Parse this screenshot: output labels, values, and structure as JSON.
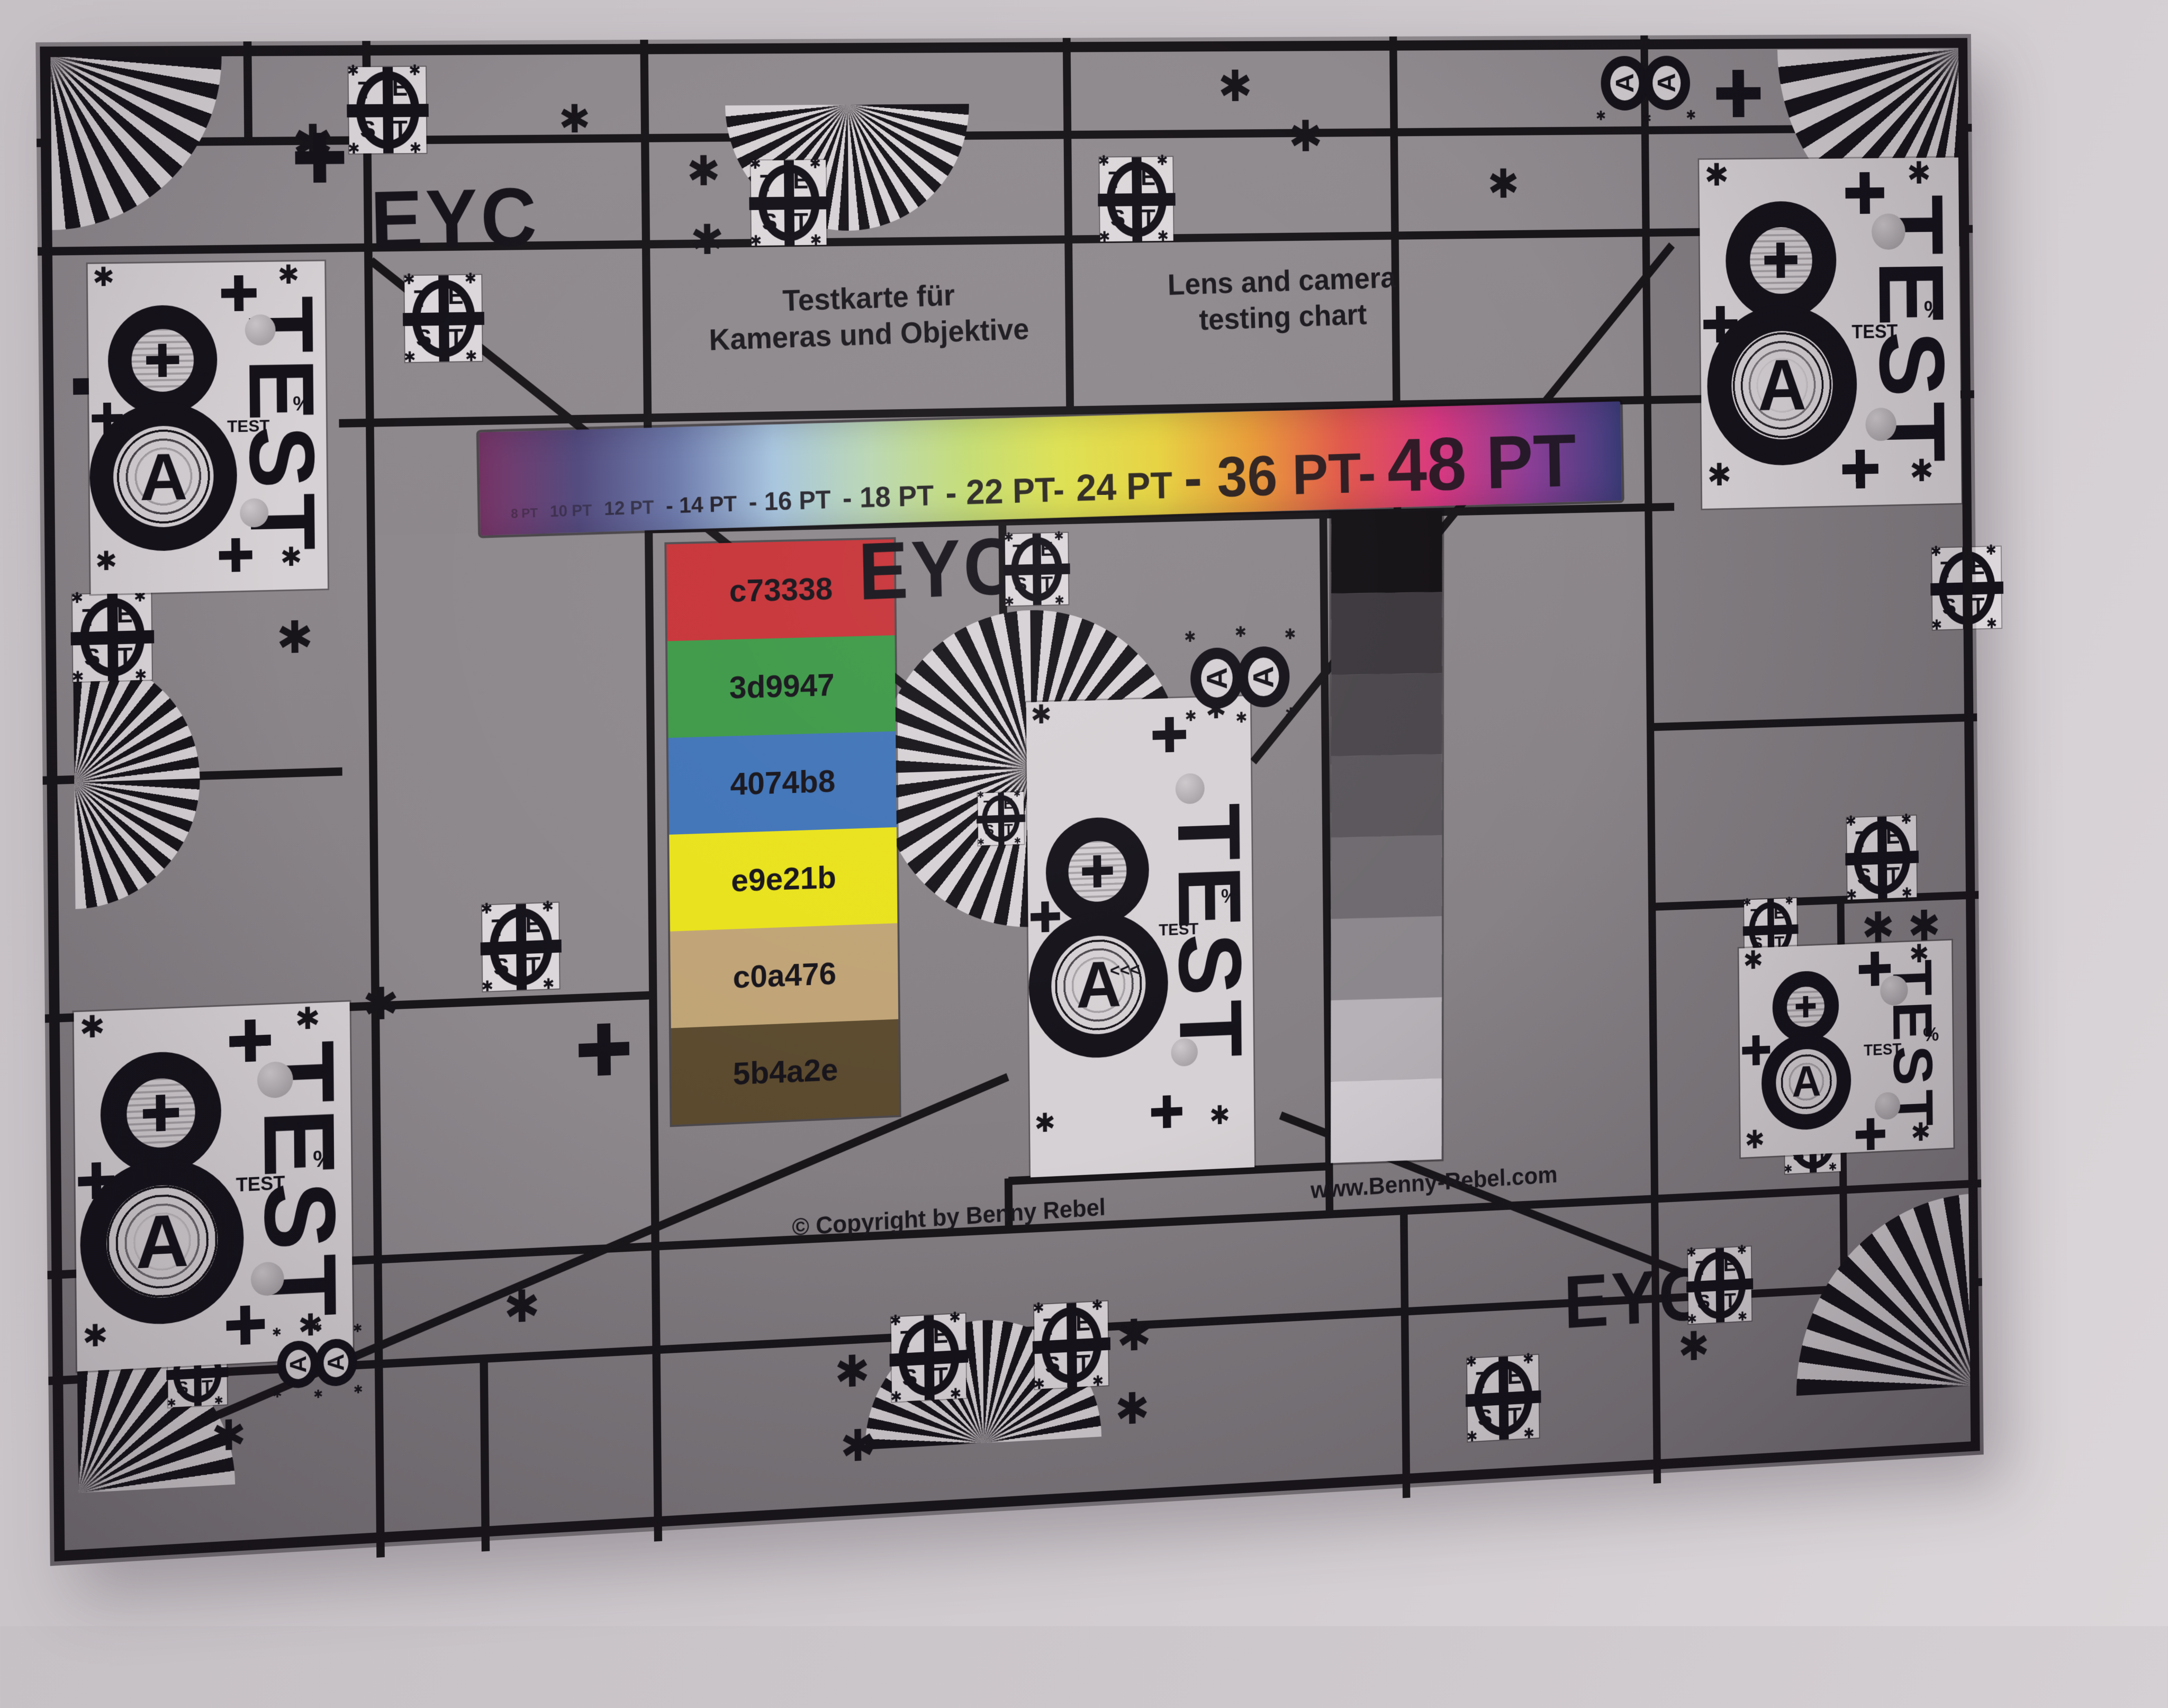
{
  "image_type": "photograph of printed lens and camera test chart on a wall",
  "chart": {
    "title_de": {
      "line1": "Testkarte für",
      "line2": "Kameras und Objektive"
    },
    "title_en": {
      "line1": "Lens and camera",
      "line2": "testing chart"
    },
    "type_scale": [
      {
        "text": "8 PT",
        "pt": 8
      },
      {
        "text": "10 PT",
        "pt": 10
      },
      {
        "text": "12 PT",
        "pt": 12
      },
      {
        "text": "- 14 PT",
        "pt": 14
      },
      {
        "text": "- 16 PT",
        "pt": 16
      },
      {
        "text": "- 18 PT",
        "pt": 18
      },
      {
        "text": "- 22 PT-",
        "pt": 22
      },
      {
        "text": "24 PT",
        "pt": 24
      },
      {
        "text": "- 36 PT-",
        "pt": 36
      },
      {
        "text": "48 PT",
        "pt": 48
      }
    ],
    "rainbow_gradient": [
      "#7a3468",
      "#50487c",
      "#6b79ab",
      "#a6c4de",
      "#b9d6b2",
      "#c3dc72",
      "#dde04e",
      "#e6d23e",
      "#e89a36",
      "#e0554a",
      "#d8367e",
      "#8a3d95",
      "#3d3f7d"
    ]
  },
  "color_swatches": [
    {
      "hex_label": "c73338",
      "color": "#c73338"
    },
    {
      "hex_label": "3d9947",
      "color": "#3d9947"
    },
    {
      "hex_label": "4074b8",
      "color": "#4074b8"
    },
    {
      "hex_label": "e9e21b",
      "color": "#e9e21b"
    },
    {
      "hex_label": "c0a476",
      "color": "#c0a476"
    },
    {
      "hex_label": "5b4a2e",
      "color": "#5b4a2e"
    }
  ],
  "grayscale_steps": [
    "#141115",
    "#3b373c",
    "#4a464b",
    "#5a565b",
    "#6e6a6f",
    "#8b878c",
    "#b5b1b6",
    "#d0ccd1"
  ],
  "eyc_label": "EYC",
  "badge": {
    "letters": [
      "T",
      "E",
      "S",
      "T"
    ]
  },
  "block": {
    "digit": "8",
    "letter": "A",
    "test_label": "TEST",
    "test_small": "TEST",
    "chevrons": "<<<",
    "percent": "%"
  },
  "glyphs": {
    "asterisk": "✱"
  },
  "footer": {
    "copyright": "© Copyright by Benny Rebel",
    "website": "www.Benny-Rebel.com"
  },
  "colors": {
    "chart_background": "#8b868a",
    "grid_line": "#19161a",
    "block_white": "#d6d1d4",
    "wall": "#cdc8cc",
    "ink": "#17141a"
  }
}
